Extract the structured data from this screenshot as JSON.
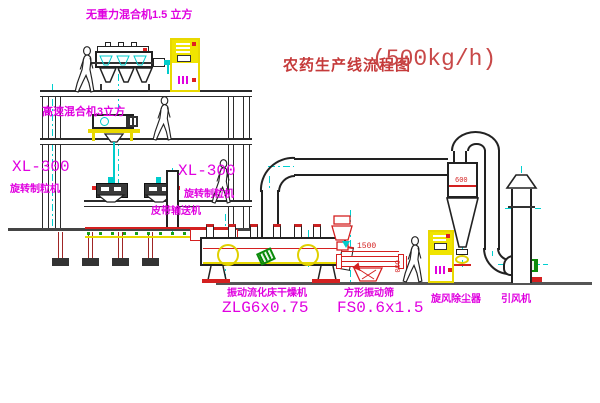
{
  "title": {
    "text": "农药生产线流程图",
    "capacity": "(500kg/h)"
  },
  "labels": {
    "gravity_mixer": "无重力混合机1.5 立方",
    "high_speed_mixer": "高速混合机3立方",
    "belt_conveyor": "皮带输送机",
    "dryer_name": "振动流化床干燥机",
    "dryer_model": "ZLG6x0.75",
    "sieve_name": "方形振动筛",
    "sieve_model": "FS0.6x1.5",
    "cyclone": "旋风除尘器",
    "fan": "引风机"
  },
  "granulators": [
    {
      "model": "XL-300",
      "name": "旋转制粒机"
    },
    {
      "model": "XL-300",
      "name": "旋转制粒机"
    }
  ],
  "dimensions": {
    "sieve_length": "1500",
    "sieve_width": "600",
    "cyclone_diameter": "600"
  },
  "colors": {
    "label_magenta": "#e000e0",
    "title_red": "#c53a3a",
    "line_dark": "#2b2b2b",
    "centerline_cyan": "#00d0d0",
    "equipment_yellow": "#f0e400",
    "dimension_red": "#d42020",
    "motor_green": "#0a8a0a"
  }
}
